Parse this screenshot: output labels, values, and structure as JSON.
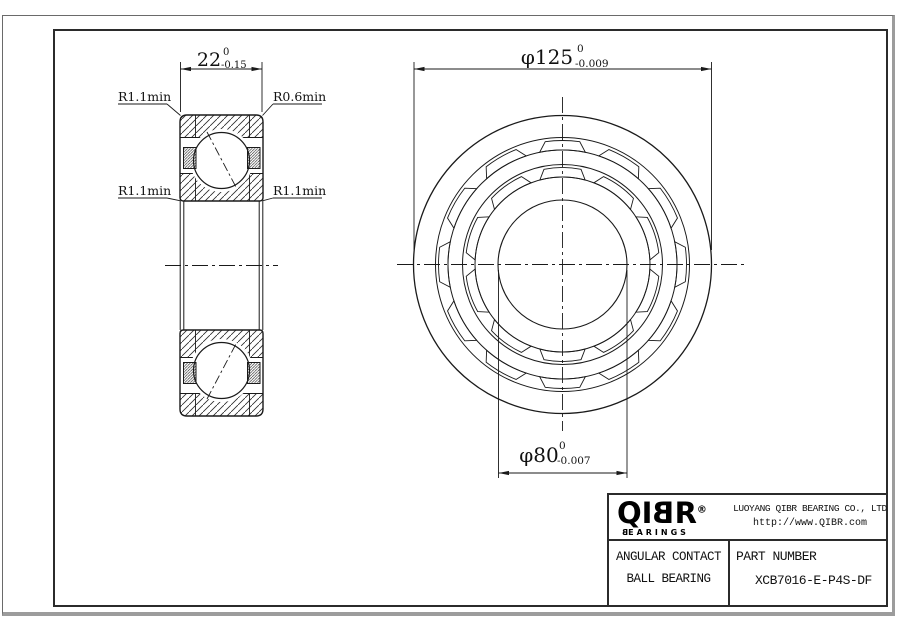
{
  "dimensions": {
    "width": {
      "value": "22",
      "tol_upper": "0",
      "tol_lower": "-0.15"
    },
    "outer_diameter": {
      "value": "φ125",
      "tol_upper": "0",
      "tol_lower": "-0.009"
    },
    "bore_diameter": {
      "value": "φ80",
      "tol_upper": "0",
      "tol_lower": "-0.007"
    }
  },
  "radius_labels": {
    "top_left": "R1.1min",
    "top_right": "R0.6min",
    "mid_left": "R1.1min",
    "mid_right": "R1.1min"
  },
  "title_block": {
    "logo_text_pre": "QI",
    "logo_text_b": "B",
    "logo_text_post": "R",
    "registered_mark": "®",
    "logo_sub_b": "B",
    "logo_sub_rest": "EARINGS",
    "company": "LUOYANG QIBR BEARING CO., LTD",
    "website": "http://www.QIBR.com",
    "product_type_line1": "ANGULAR CONTACT",
    "product_type_line2": "BALL BEARING",
    "part_number_label": "PART NUMBER",
    "part_number": "XCB7016-E-P4S-DF"
  }
}
